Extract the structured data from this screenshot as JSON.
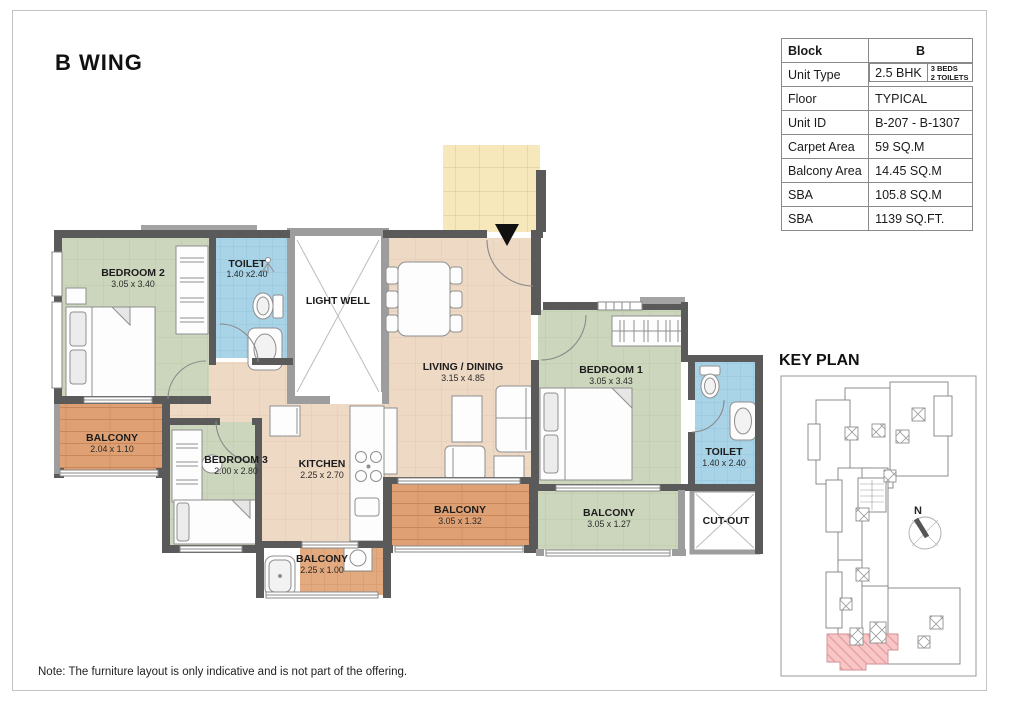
{
  "page": {
    "title": "B WING",
    "note": "Note: The furniture layout is only indicative and is not part of the offering."
  },
  "info_table": {
    "rows": [
      {
        "label": "Block",
        "value": "B"
      },
      {
        "label": "Unit Type",
        "value": "2.5 BHK",
        "extra1": "3 BEDS",
        "extra2": "2 TOILETS"
      },
      {
        "label": "Floor",
        "value": "TYPICAL"
      },
      {
        "label": "Unit ID",
        "value": "B-207 - B-1307"
      },
      {
        "label": "Carpet Area",
        "value": "59 SQ.M"
      },
      {
        "label": "Balcony Area",
        "value": "14.45 SQ.M"
      },
      {
        "label": "SBA",
        "value": "105.8 SQ.M"
      },
      {
        "label": "SBA",
        "value": "1139 SQ.FT."
      }
    ]
  },
  "key_plan": {
    "title": "KEY PLAN",
    "compass_label": "N"
  },
  "rooms": {
    "bedroom2": {
      "name": "BEDROOM 2",
      "dims": "3.05 x 3.40"
    },
    "toilet_top": {
      "name": "TOILET",
      "dims": "1.40 x2.40"
    },
    "lightwell": {
      "name": "LIGHT WELL"
    },
    "living": {
      "name": "LIVING / DINING",
      "dims": "3.15 x 4.85"
    },
    "bedroom1": {
      "name": "BEDROOM 1",
      "dims": "3.05 x 3.43"
    },
    "toilet_right": {
      "name": "TOILET",
      "dims": "1.40 x 2.40"
    },
    "balcony_left": {
      "name": "BALCONY",
      "dims": "2.04 x 1.10"
    },
    "bedroom3": {
      "name": "BEDROOM 3",
      "dims": "2.00 x 2.80"
    },
    "kitchen": {
      "name": "KITCHEN",
      "dims": "2.25 x 2.70"
    },
    "balcony_center": {
      "name": "BALCONY",
      "dims": "3.05 x 1.32"
    },
    "balcony_right": {
      "name": "BALCONY",
      "dims": "3.05 x 1.27"
    },
    "cutout": {
      "name": "CUT-OUT"
    },
    "balcony_small": {
      "name": "BALCONY",
      "dims": "2.25 x 1.00"
    }
  },
  "colors": {
    "wall_dark": "#5a5a5a",
    "wall_light": "#9d9d9d",
    "floor_tan": "#eed9c5",
    "room_green": "#ccd6bc",
    "toilet_blue": "#a9d3e6",
    "lobby_yellow": "#f6e8ba",
    "balcony_wood": "#dfa173",
    "balcony_tile": "#e3aa80",
    "keyplan_highlight": "#f8c6c7"
  }
}
